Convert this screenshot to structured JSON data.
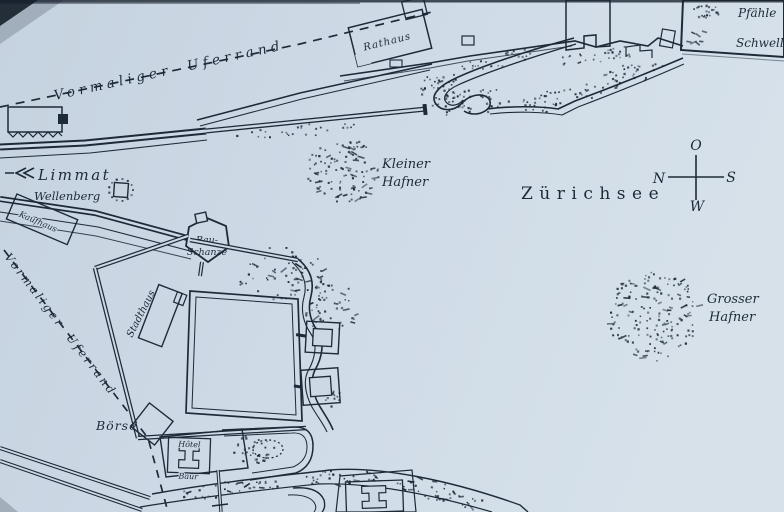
{
  "map": {
    "lake_label": "Zürichsee",
    "river_label": "Limmat",
    "former_shoreline_top": "Vormaliger Uferrand",
    "former_shoreline_left": "Vormaliger Uferrand",
    "shallows": {
      "kleiner_hafner": [
        "Kleiner",
        "Hafner"
      ],
      "grosser_hafner": [
        "Grosser",
        "Hafner"
      ]
    },
    "buildings": {
      "rathaus": "Rathaus",
      "kaufhaus": "Kaufhaus",
      "wellenberg": "Wellenberg",
      "bauschanze": [
        "Bau-",
        "Schanze"
      ],
      "stadthaus": "Stadthaus",
      "boerse": "Börse",
      "hotel_baur": [
        "Hôtel",
        "Baur"
      ]
    },
    "legend": {
      "items": [
        {
          "symbol": "piles-dots",
          "label": "Pfähle"
        },
        {
          "symbol": "sleepers-dashes",
          "label": "Schwellen"
        }
      ]
    },
    "compass": {
      "top": "O",
      "left": "N",
      "right": "S",
      "bottom": "W"
    },
    "colors": {
      "paper": "#ccd8e4",
      "ink": "#1e2a38"
    }
  }
}
